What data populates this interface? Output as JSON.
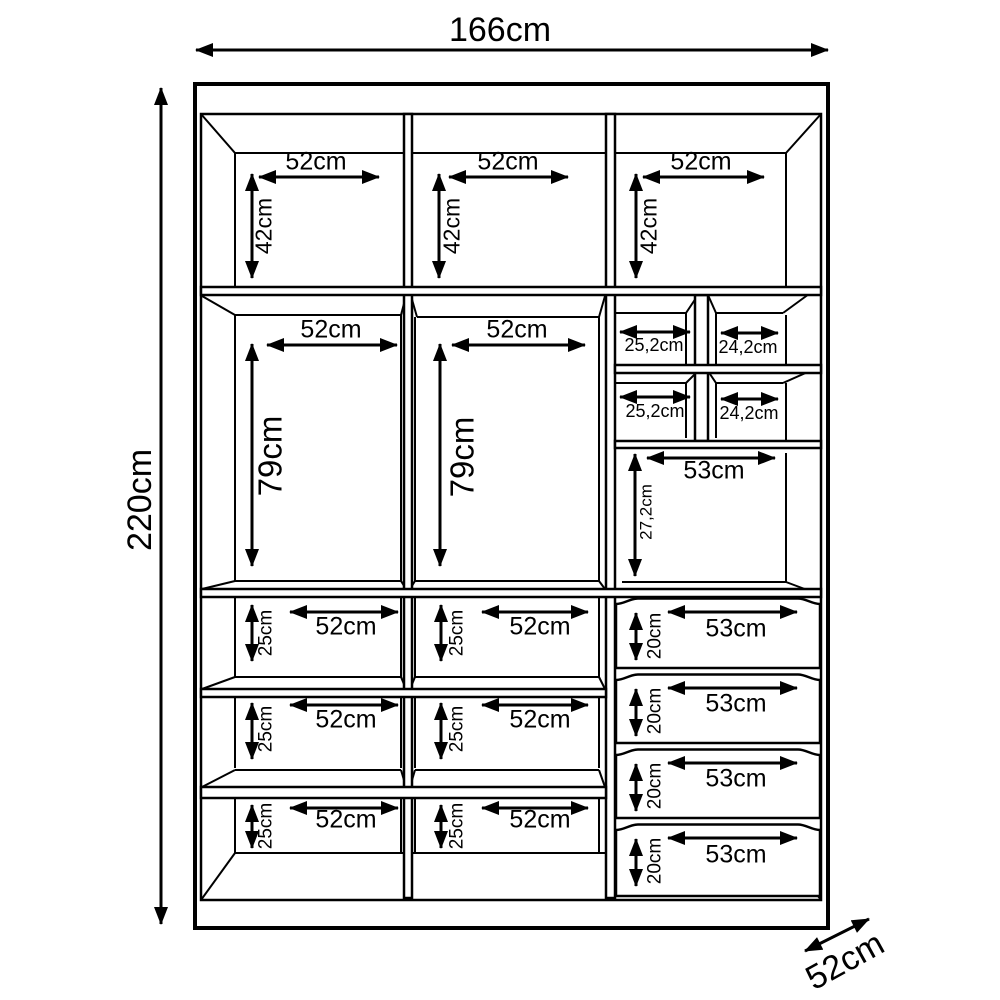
{
  "overall": {
    "width": "166cm",
    "height": "220cm",
    "depth": "52cm"
  },
  "top_shelf_section": {
    "width": "52cm",
    "height": "42cm"
  },
  "hanging_section": {
    "width": "52cm",
    "height": "79cm"
  },
  "cubby_left": {
    "width": "25,2cm"
  },
  "cubby_right": {
    "width": "24,2cm"
  },
  "right_mid_section": {
    "width": "53cm",
    "height": "27,2cm"
  },
  "shelf_section": {
    "width": "52cm",
    "height": "25cm"
  },
  "drawer": {
    "width": "53cm",
    "height": "20cm"
  }
}
